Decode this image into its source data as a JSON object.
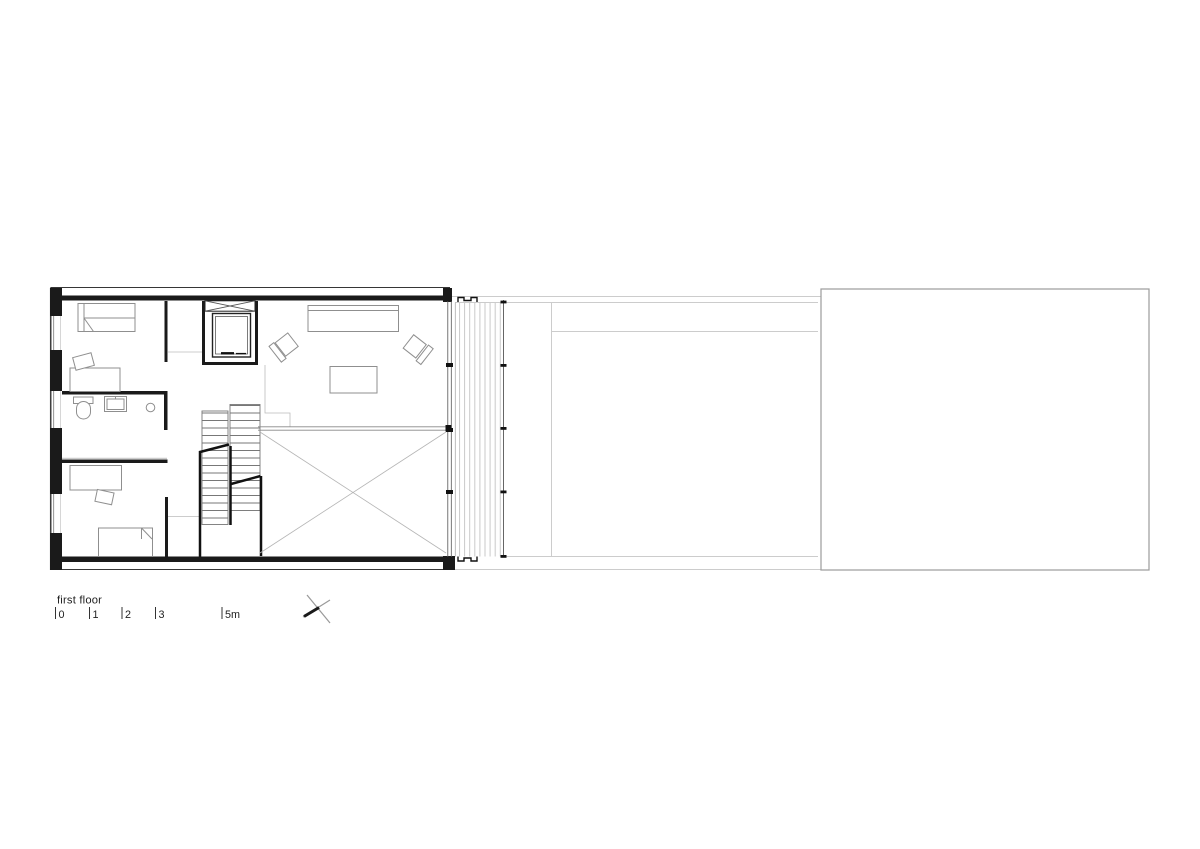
{
  "drawing": {
    "caption": "first floor",
    "scale_bar": {
      "labels": [
        "0",
        "1",
        "2",
        "3",
        "5m"
      ]
    },
    "icons": [
      "north-arrow-icon"
    ],
    "colors": {
      "wall": "#1a1a1a",
      "furniture": "#8f8f8f",
      "stair": "#777777",
      "site_outline": "#cccccc",
      "annex_outline": "#9b9b9b",
      "deck_plank": "#c9c9c9",
      "text": "#222222",
      "background": "#ffffff"
    }
  }
}
